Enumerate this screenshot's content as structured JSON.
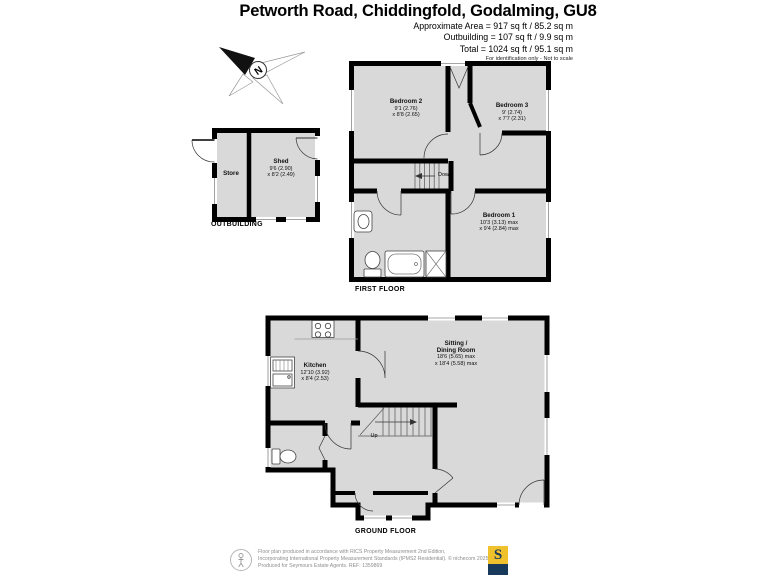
{
  "header": {
    "title": "Petworth Road, Chiddingfold, Godalming, GU8",
    "area_line1": "Approximate Area = 917 sq ft / 85.2 sq m",
    "area_line2": "Outbuilding = 107 sq ft / 9.9 sq m",
    "area_line3": "Total = 1024 sq ft / 95.1 sq m",
    "note": "For identification only - Not to scale"
  },
  "compass": {
    "north_label": "N"
  },
  "outbuilding": {
    "caption": "OUTBUILDING",
    "store": {
      "name": "Store"
    },
    "shed": {
      "name": "Shed",
      "dim1": "9'6 (2.90)",
      "dim2": "x 8'2 (2.49)"
    }
  },
  "first_floor": {
    "caption": "FIRST FLOOR",
    "stairs_label": "Down",
    "bedroom2": {
      "name": "Bedroom 2",
      "dim1": "9'1 (2.76)",
      "dim2": "x 8'8 (2.65)"
    },
    "bedroom3": {
      "name": "Bedroom 3",
      "dim1": "9' (2.74)",
      "dim2": "x 7'7 (2.31)"
    },
    "bedroom1": {
      "name": "Bedroom 1",
      "dim1": "10'3 (3.13) max",
      "dim2": "x 9'4 (2.84) max"
    }
  },
  "ground_floor": {
    "caption": "GROUND FLOOR",
    "stairs_label": "Up",
    "kitchen": {
      "name": "Kitchen",
      "dim1": "12'10 (3.92)",
      "dim2": "x 8'4 (2.53)"
    },
    "sitting": {
      "name_line1": "Sitting /",
      "name_line2": "Dining Room",
      "dim1": "18'6 (5.65) max",
      "dim2": "x 18'4 (5.58) max"
    }
  },
  "footer": {
    "line1": "Floor plan produced in accordance with RICS Property Measurement 2nd Edition,",
    "line2": "Incorporating International Property Measurement Standards (IPMS2 Residential).  © nichecom 2025.",
    "line3": "Produced for Seymours Estate Agents.   REF: 1359869",
    "logo_letter": "S"
  },
  "colors": {
    "wall": "#000000",
    "floor": "#d9d9d9",
    "logo_yellow": "#eec12d",
    "logo_navy": "#17395a"
  }
}
